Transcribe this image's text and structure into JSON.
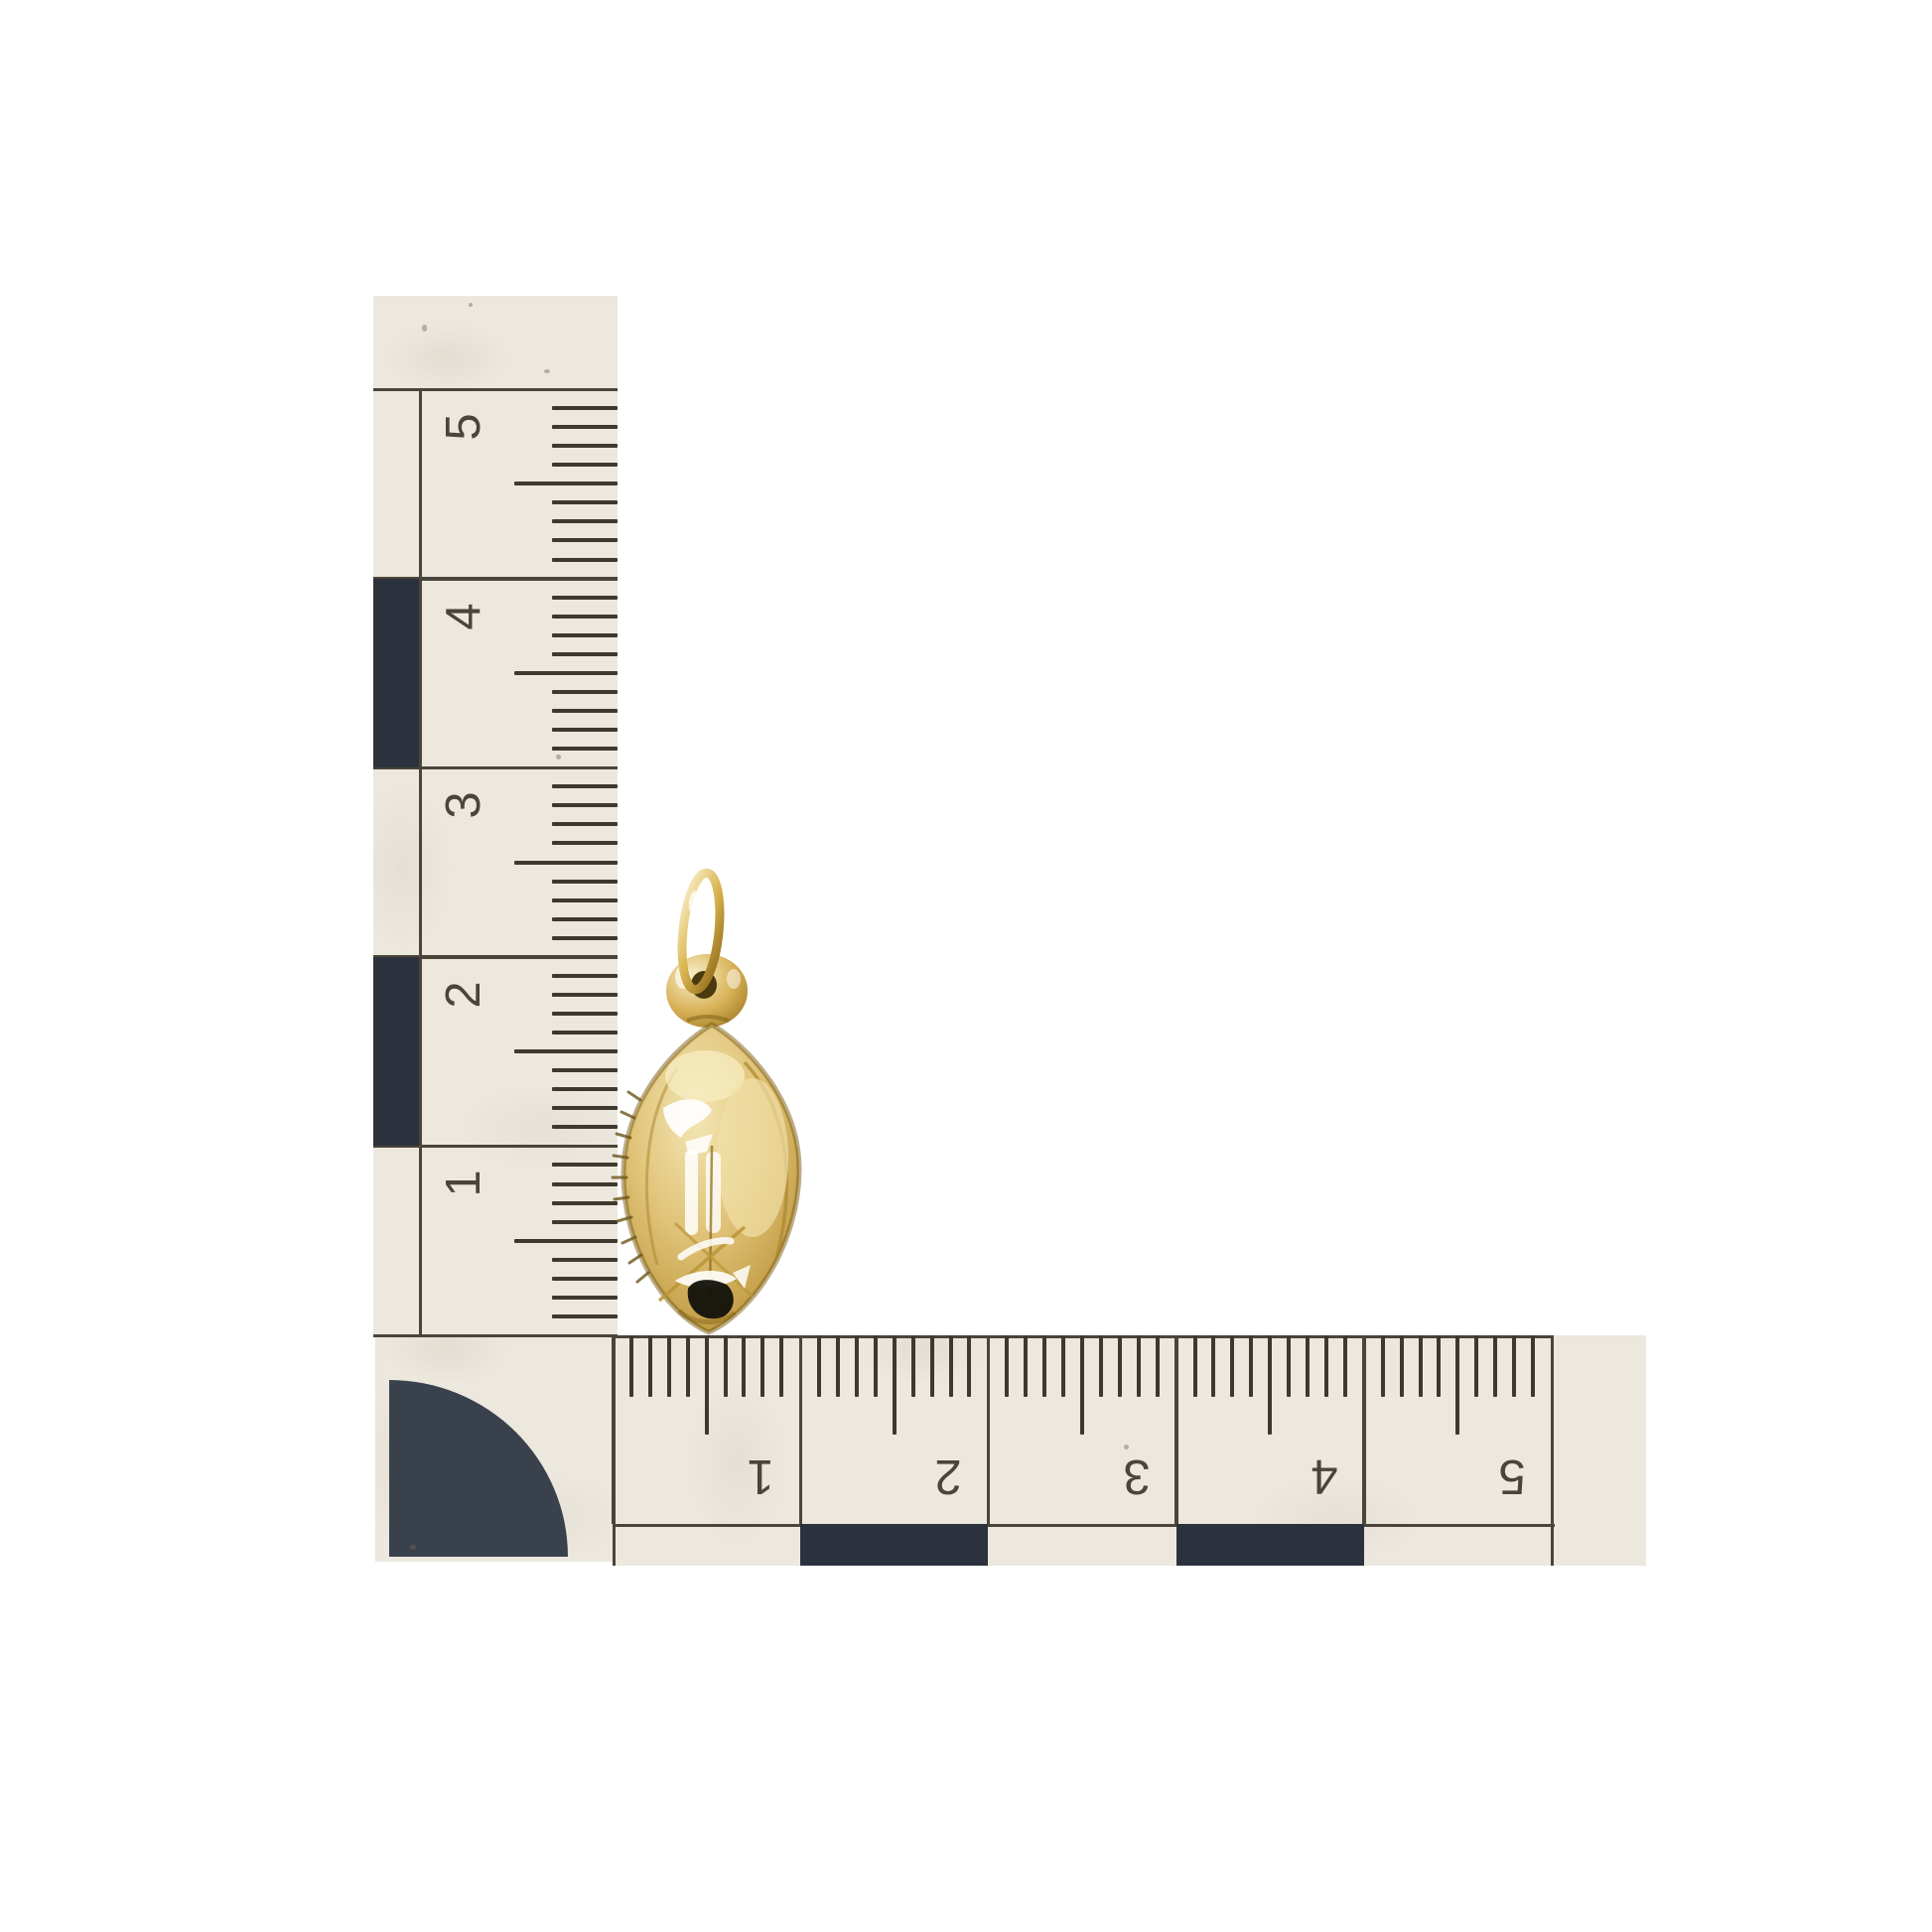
{
  "scene": {
    "subject": "gold football charm pendant photographed with two centimetre scale rulers arranged in an L",
    "background_color": "#ffffff"
  },
  "vertical_ruler": {
    "unit": "cm",
    "numbers": [
      "5",
      "4",
      "3",
      "2",
      "1"
    ],
    "orientation": "vertical",
    "ticks_per_cm": 10
  },
  "horizontal_ruler": {
    "unit": "cm",
    "numbers": [
      "1",
      "2",
      "3",
      "4",
      "5"
    ],
    "orientation": "horizontal",
    "ticks_per_cm": 10
  },
  "charm": {
    "name": "gold football charm",
    "parts": {
      "ring": "jump ring",
      "bail": "bail loop",
      "body": "football body"
    }
  },
  "palette": {
    "ruler_paper": "#ece8de",
    "ruler_ink": "#4b443a",
    "checker_dark": "#2c323d",
    "gold": "#c9a44a",
    "gold_dark": "#8d6c1d",
    "highlight": "#ffffff"
  }
}
